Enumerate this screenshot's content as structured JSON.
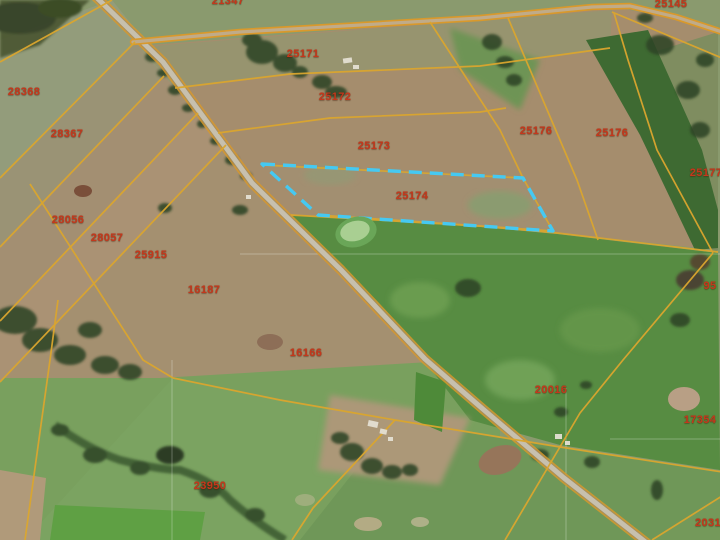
{
  "app": {
    "type": "gis-satellite-parcel-viewer",
    "basemap": "satellite-imagery"
  },
  "map": {
    "selected_parcel_id": "25174",
    "colors": {
      "parcel_boundary": "#dba62e",
      "parcel_label": "#c4381c",
      "selection_outline": "#45c9f2",
      "road_surface": "#c7c0ae",
      "road_casing": "#d9992b"
    },
    "parcel_labels": [
      {
        "id": "21347",
        "x": 228,
        "y": 1
      },
      {
        "id": "25145",
        "x": 671,
        "y": 4
      },
      {
        "id": "28368",
        "x": 24,
        "y": 92
      },
      {
        "id": "28367",
        "x": 67,
        "y": 134
      },
      {
        "id": "25171",
        "x": 303,
        "y": 54
      },
      {
        "id": "25172",
        "x": 335,
        "y": 97
      },
      {
        "id": "25173",
        "x": 374,
        "y": 146
      },
      {
        "id": "25174",
        "x": 412,
        "y": 196
      },
      {
        "id": "25176",
        "x": 536,
        "y": 131
      },
      {
        "id": "25176",
        "x": 612,
        "y": 133
      },
      {
        "id": "25177",
        "x": 706,
        "y": 173
      },
      {
        "id": "28056",
        "x": 68,
        "y": 220
      },
      {
        "id": "28057",
        "x": 107,
        "y": 238
      },
      {
        "id": "25915",
        "x": 151,
        "y": 255
      },
      {
        "id": "16187",
        "x": 204,
        "y": 290
      },
      {
        "id": "95",
        "x": 710,
        "y": 286
      },
      {
        "id": "16166",
        "x": 306,
        "y": 353
      },
      {
        "id": "23950",
        "x": 210,
        "y": 486
      },
      {
        "id": "20016",
        "x": 551,
        "y": 390
      },
      {
        "id": "17354",
        "x": 700,
        "y": 420
      },
      {
        "id": "2031",
        "x": 708,
        "y": 523
      }
    ]
  }
}
